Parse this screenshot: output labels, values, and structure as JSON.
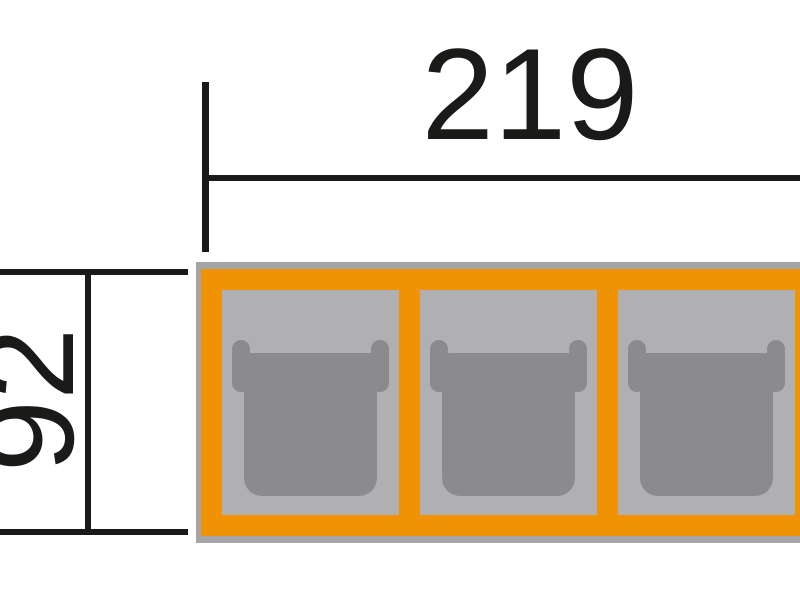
{
  "diagram": {
    "type": "technical-dimension-drawing",
    "subject": "three-bay carport top view with parked cars, cropped at right edge",
    "dimension_width": {
      "value": "219",
      "orientation": "horizontal"
    },
    "dimension_depth": {
      "value": "92",
      "orientation": "vertical-rotated-90ccw"
    },
    "bays": [
      {
        "id": "carport-bay-1",
        "occupant": "car"
      },
      {
        "id": "carport-bay-2",
        "occupant": "car"
      },
      {
        "id": "carport-bay-3",
        "occupant": "car"
      }
    ],
    "colors": {
      "background": "#ffffff",
      "line_ink": "#1a1a18",
      "frame_orange": "#ef9304",
      "outer_border_gray": "#a5a5a7",
      "bay_floor_gray": "#b0b0b2",
      "car_gray": "#8b8b8d"
    }
  }
}
